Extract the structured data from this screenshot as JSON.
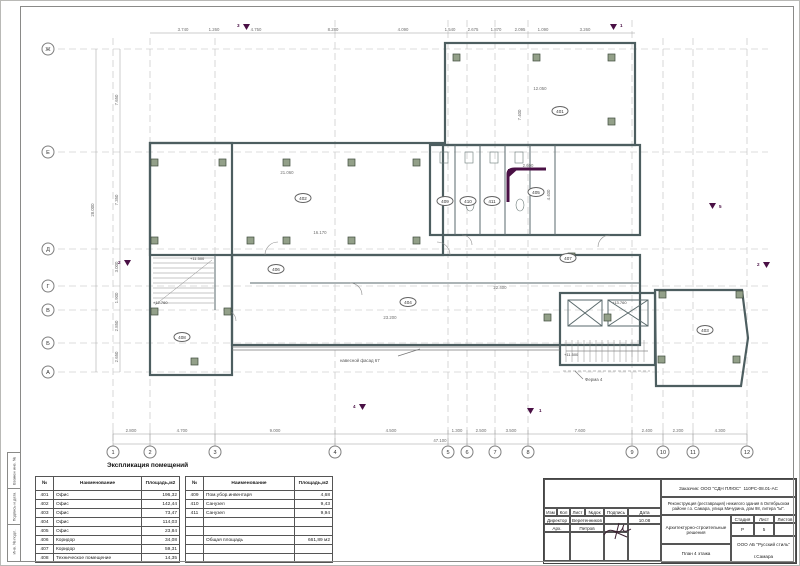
{
  "sheet": {
    "frame_labels": [
      "Взамен инв. №",
      "Подпись и дата",
      "Инв. № подл."
    ]
  },
  "plan": {
    "axes_bottom": [
      "1",
      "2",
      "3",
      "4",
      "5",
      "6",
      "7",
      "8",
      "9",
      "10",
      "11",
      "12"
    ],
    "axes_left": [
      "Ж",
      "Е",
      "Д",
      "Г",
      "В",
      "Б",
      "А"
    ],
    "rooms": [
      "401",
      "402",
      "403",
      "404",
      "405",
      "406",
      "407",
      "408",
      "409",
      "410",
      "411"
    ],
    "dims_top": [
      "3.740",
      "1.260",
      "4.750",
      "8.280",
      "4.090",
      "1.540",
      "2.675",
      "1.870",
      "2.095",
      "1.090",
      "3.260"
    ],
    "dims_bottom": [
      "2.800",
      "4.700",
      "9.000",
      "4.500",
      "1.300",
      "2.500",
      "3.500",
      "7.600",
      "2.400",
      "2.200",
      "4.300"
    ],
    "dims_left": [
      "7.650",
      "7.350",
      "3.000",
      "1.900",
      "2.850",
      "2.650"
    ],
    "total_bottom": "47.100",
    "total_left": "28.000",
    "dims_inner": [
      "21.060",
      "12.050",
      "7.400",
      "16.170",
      "22.400",
      "23.200",
      "2.600",
      "4.400"
    ],
    "elevations": [
      "+11.500",
      "+12.760",
      "+13.760",
      "+11.500"
    ],
    "notes": {
      "facade": "навесной фасад 67",
      "truss": "Ферма 4"
    },
    "markers": [
      "3",
      "1",
      "5",
      "2",
      "2",
      "4",
      "1"
    ]
  },
  "explication": {
    "title": "Экспликация помещений",
    "headers": [
      "№",
      "Наименование",
      "Площадь,м2"
    ],
    "left_rows": [
      [
        "401",
        "Офис",
        "196,32"
      ],
      [
        "402",
        "Офис",
        "142,44"
      ],
      [
        "403",
        "Офис",
        "73,47"
      ],
      [
        "404",
        "Офис",
        "114,03"
      ],
      [
        "405",
        "Офис",
        "23,84"
      ],
      [
        "406",
        "Коридор",
        "34,08"
      ],
      [
        "407",
        "Коридор",
        "59,31"
      ],
      [
        "408",
        "Техническое помещение",
        "14,35"
      ]
    ],
    "right_rows": [
      [
        "409",
        "Пом.убор.инвентаря",
        "4,68"
      ],
      [
        "410",
        "Санузел",
        "9,43"
      ],
      [
        "411",
        "Санузел",
        "9,94"
      ]
    ],
    "total_label": "Общая площадь",
    "total_value": "661,89 м2"
  },
  "titleblock": {
    "client": "Заказчик: ООО \"СДН ПЛЮС\"",
    "doc_number": "110РС-08.01-АС",
    "project": "Реконструкция (реставрация) нежилого здания в Октябрьском районе г.о. Самара, улица Мичурина, дом 98, литера \"Ы\".",
    "columns": [
      "Изм",
      "Кол",
      "Лист",
      "№док",
      "Подпись",
      "Дата"
    ],
    "date": "10.08",
    "role1": "Директор",
    "name1": "Веретенников",
    "role2": "Арх.",
    "name2": "Петров",
    "section": "Архитектурно-строительные решения",
    "stage_headers": [
      "Стадия",
      "Лист",
      "Листов"
    ],
    "stage": "Р",
    "sheet_no": "5",
    "drawing_title": "План 4 этажа",
    "company": "ООО АБ \"Русский стиль\"",
    "city": "г.Самара"
  }
}
